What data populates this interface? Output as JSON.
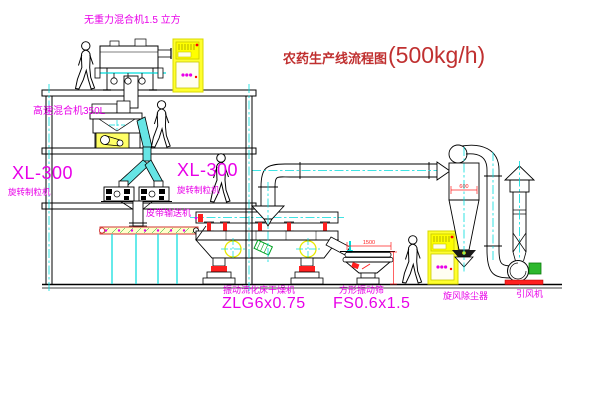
{
  "title": {
    "name": "农药生产线流程图",
    "capacity": "(500kg/h)"
  },
  "labels": {
    "gravity_mixer": "无重力混合机1.5 立方",
    "high_speed_mixer": "高速混合机350L",
    "granulator_left_model": "XL-300",
    "granulator_left_name": "旋转制粒机",
    "granulator_center_model": "XL-300",
    "granulator_center_name": "旋转制粒机",
    "belt_conveyor": "皮带输送机",
    "dryer_name": "振动流化床干燥机",
    "dryer_model": "ZLG6x0.75",
    "sieve_name": "方形振动筛",
    "sieve_model": "FS0.6x1.5",
    "cyclone": "旋风除尘器",
    "fan": "引风机"
  },
  "dimensions": {
    "sieve_length": "1500",
    "cyclone_diameter": "600"
  },
  "colors": {
    "label_magenta": "#e800e8",
    "title_red": "#c03030",
    "centerline_cyan": "#00dcdc",
    "duct_cyan": "#66e5e5",
    "cabinet_yellow": "#ffff2e",
    "dimension_red": "#ff2020",
    "line_black": "#000000"
  }
}
